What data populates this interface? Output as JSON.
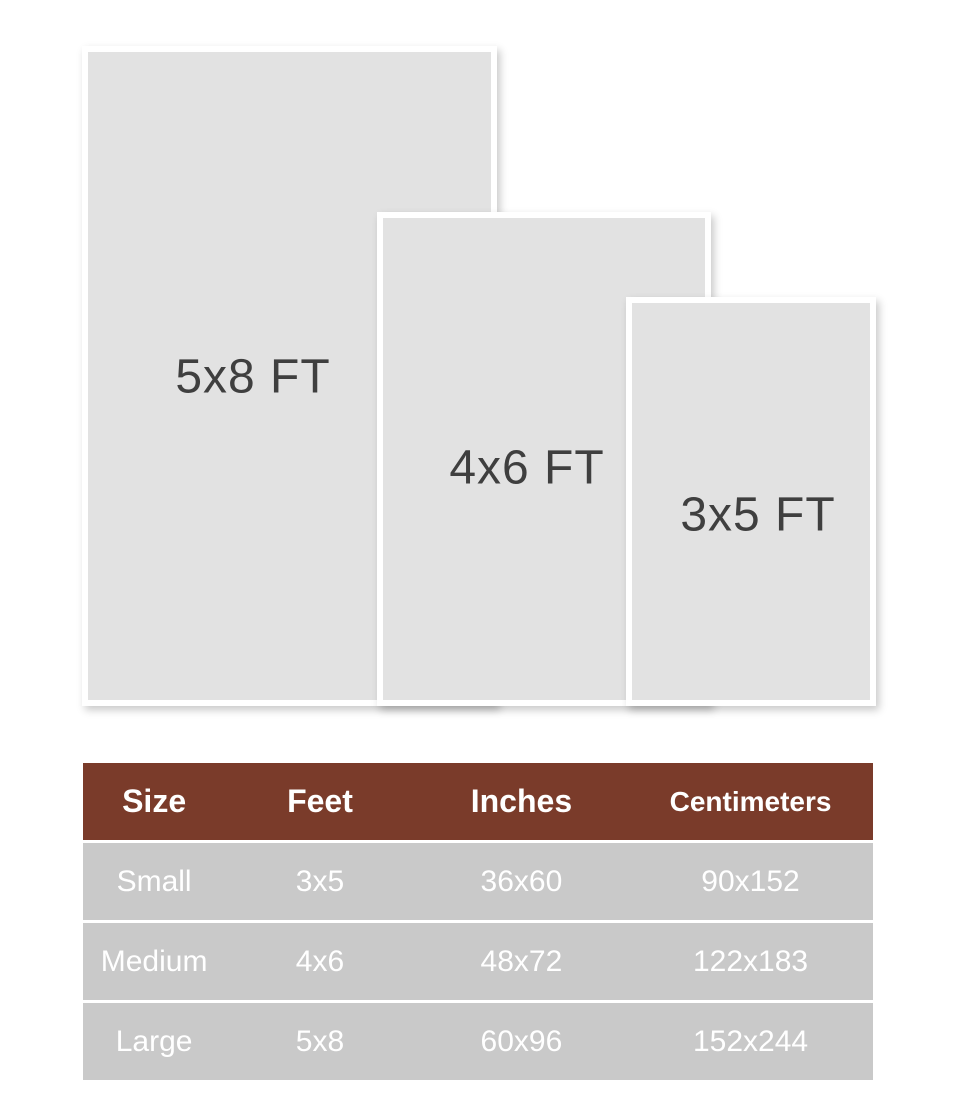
{
  "diagram": {
    "rects": [
      {
        "label": "5x8 FT"
      },
      {
        "label": "4x6 FT"
      },
      {
        "label": "3x5 FT"
      }
    ],
    "rect_fill_color": "#e2e2e2",
    "rect_frame_color": "#ffffff",
    "label_color": "#3f3f3f"
  },
  "size_table": {
    "header": [
      "Size",
      "Feet",
      "Inches",
      "Centimeters"
    ],
    "rows": [
      [
        "Small",
        "3x5",
        "36x60",
        "90x152"
      ],
      [
        "Medium",
        "4x6",
        "48x72",
        "122x183"
      ],
      [
        "Large",
        "5x8",
        "60x96",
        "152x244"
      ]
    ],
    "header_bg_color": "#7a3b2a",
    "header_text_color": "#ffffff",
    "row_bg_color": "#c9c9c9",
    "row_text_color": "#ffffff"
  }
}
